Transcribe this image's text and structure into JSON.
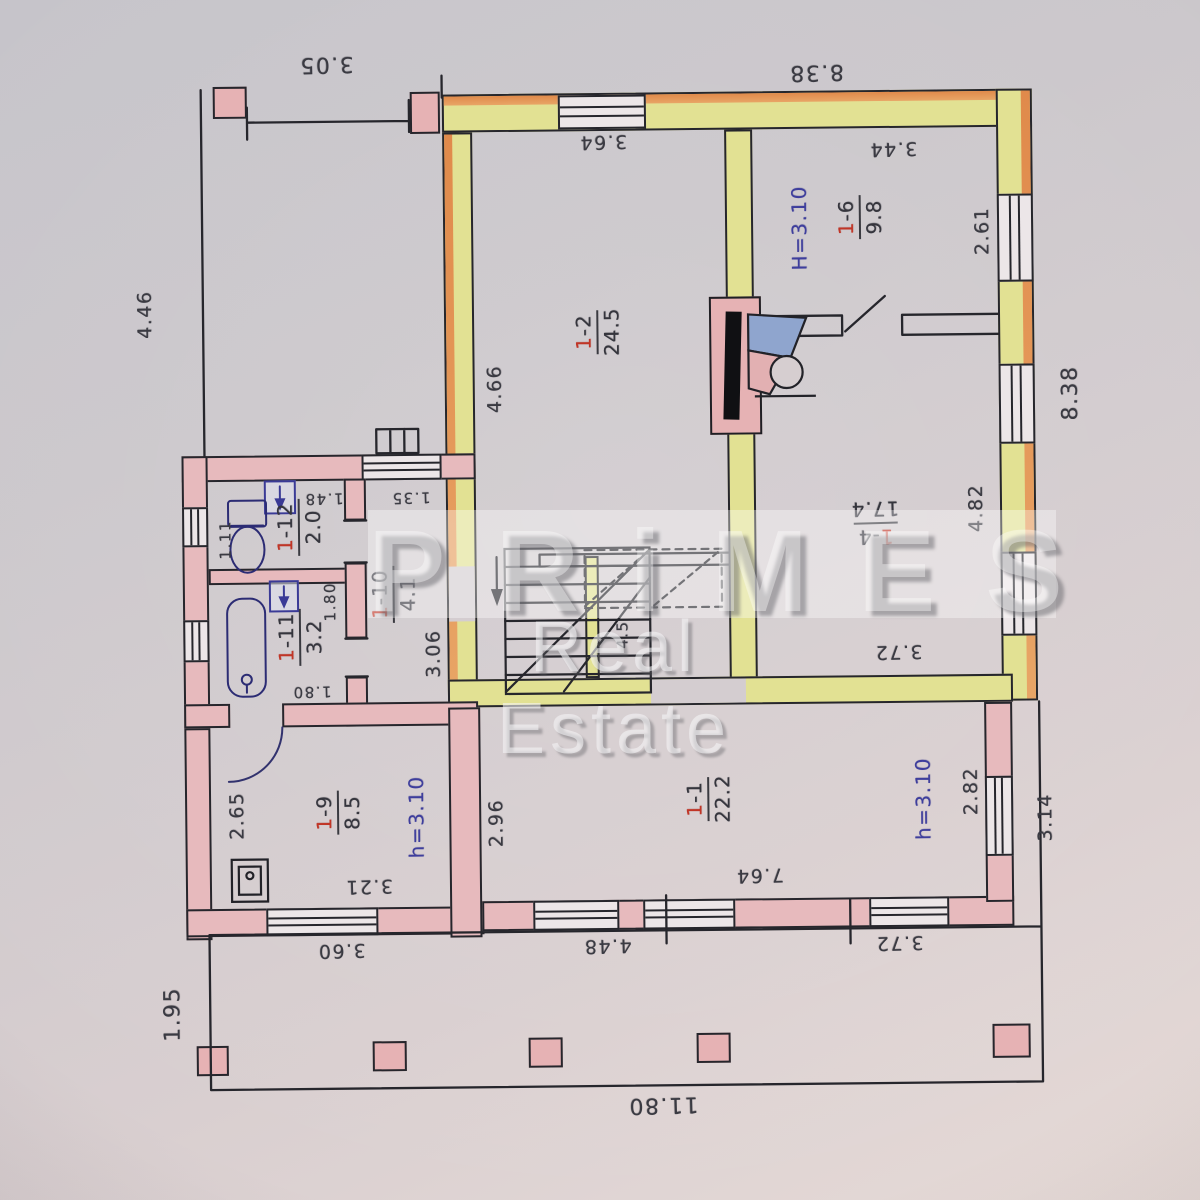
{
  "watermark": {
    "brand": "PRiMES",
    "tagline": "Real Estate"
  },
  "rooms": {
    "r1_1": {
      "number_prefix": "1",
      "number_suffix": "-1",
      "area": "22.2"
    },
    "r1_2": {
      "number_prefix": "1",
      "number_suffix": "-2",
      "area": "24.5"
    },
    "r1_4": {
      "number_prefix": "1",
      "number_suffix": "-4",
      "area": "17.4"
    },
    "r1_6": {
      "number_prefix": "1",
      "number_suffix": "-6",
      "area": "9.8"
    },
    "r1_9": {
      "number_prefix": "1",
      "number_suffix": "-9",
      "area": "8.5"
    },
    "r1_10": {
      "number_prefix": "1",
      "number_suffix": "-10",
      "area": "4.1"
    },
    "r1_11": {
      "number_prefix": "1",
      "number_suffix": "-11",
      "area": "3.2"
    },
    "r1_12": {
      "number_prefix": "1",
      "number_suffix": "-12",
      "area": "2.0"
    }
  },
  "heights": {
    "room16": "H=3.10",
    "room19": "h=3.10",
    "room11": "h=3.10"
  },
  "dimensions": {
    "terrace_top": "3.05",
    "terrace_left": "4.46",
    "main_top": "8.38",
    "main_right": "8.38",
    "room12_width": "3.64",
    "room12_depth": "4.66",
    "room16_width": "3.44",
    "room16_window": "2.61",
    "room14_depth": "4.82",
    "room14_width": "3.72",
    "hall_window": "1.35",
    "hall_left": "3.06",
    "stair_width": "4.5",
    "wc_width": "1.48",
    "wc_depth": "1.11",
    "bath_width": "1.80",
    "bath_depth": "1.80",
    "room19_depth": "2.65",
    "room19_width": "3.21",
    "room11_depth": "2.96",
    "room11_width": "7.64",
    "room11_window": "2.82",
    "porch_right": "3.14",
    "porch_bottom_right": "3.72",
    "porch_bottom_left": "3.60",
    "porch_bottom_mid": "4.48",
    "house_width": "11.80",
    "porch_depth": "1.95"
  },
  "colors": {
    "wall_highlight_yellow": "#e2e193",
    "wall_highlight_orange": "#e08a4b",
    "wall_pink": "#e7babd",
    "pen_red": "#c13526",
    "pen_blue": "#3e3e9d",
    "fireplace_blue": "#8fa5ce",
    "line_black": "#26262c"
  }
}
